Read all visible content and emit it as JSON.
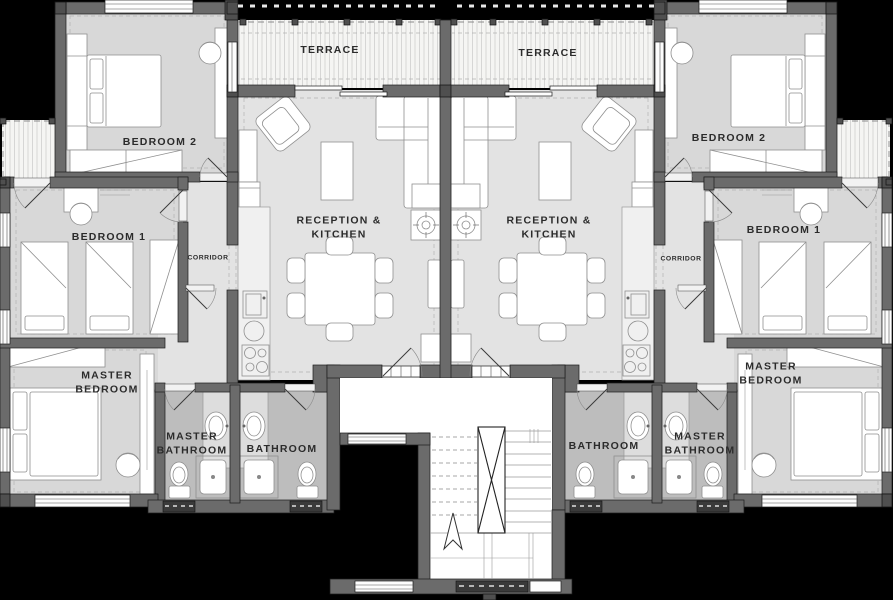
{
  "plan": {
    "title": "two-apartment residential floor plan",
    "colors": {
      "background": "#000000",
      "room_floor": "#d8d8d8",
      "reception_floor": "#e3e3e3",
      "bathroom_floor": "#bdbdbd",
      "terrace_floor": "#f5f5f3",
      "wall": "#6b6b6b",
      "wall_dark": "#4f4f4f",
      "furniture": "#ffffff",
      "label_text": "#2b2b2b"
    },
    "units": [
      {
        "name": "left-apartment",
        "rooms": {
          "terrace": "TERRACE",
          "bedroom2": "BEDROOM 2",
          "bedroom1": "BEDROOM 1",
          "corridor": "CORRIDOR",
          "reception_kitchen": "RECEPTION & KITCHEN",
          "master_bedroom": "MASTER BEDROOM",
          "master_bathroom": "MASTER BATHROOM",
          "bathroom": "BATHROOM"
        }
      },
      {
        "name": "right-apartment",
        "rooms": {
          "terrace": "TERRACE",
          "bedroom2": "BEDROOM 2",
          "bedroom1": "BEDROOM 1",
          "corridor": "CORRIDOR",
          "reception_kitchen": "RECEPTION & KITCHEN",
          "master_bedroom": "MASTER BEDROOM",
          "master_bathroom": "MASTER BATHROOM",
          "bathroom": "BATHROOM"
        }
      }
    ]
  }
}
